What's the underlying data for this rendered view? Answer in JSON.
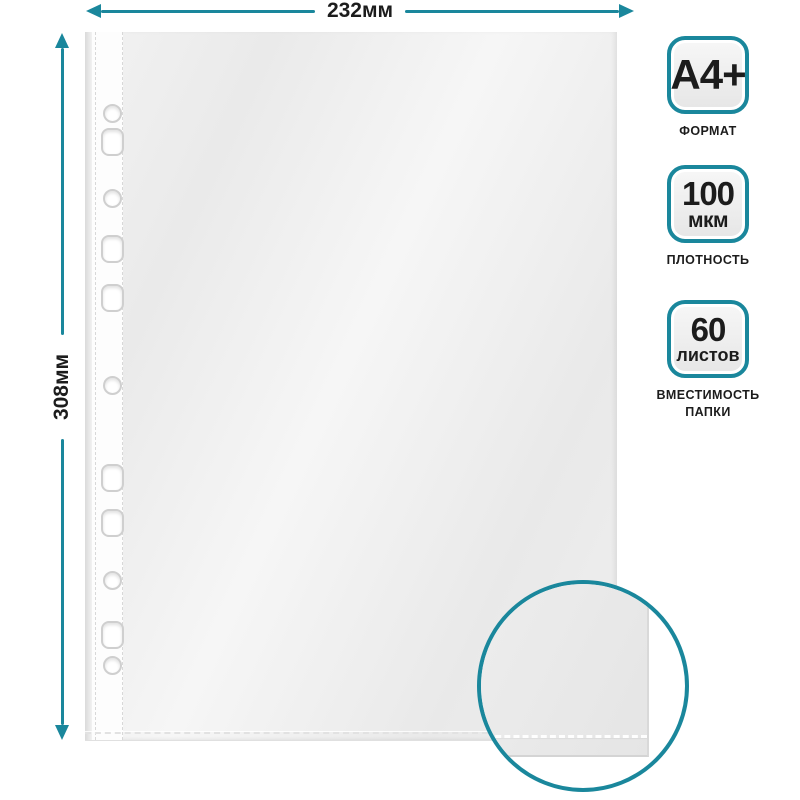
{
  "accent_color": "#1a879c",
  "dimensions": {
    "width_label": "232мм",
    "height_label": "308мм"
  },
  "badges": [
    {
      "value_line1": "A4+",
      "value_line2": "",
      "caption_line1": "ФОРМАТ",
      "caption_line2": ""
    },
    {
      "value_line1": "100",
      "value_line2": "мкм",
      "caption_line1": "ПЛОТНОСТЬ",
      "caption_line2": ""
    },
    {
      "value_line1": "60",
      "value_line2": "листов",
      "caption_line1": "ВМЕСТИМОСТЬ",
      "caption_line2": "ПАПКИ"
    }
  ]
}
